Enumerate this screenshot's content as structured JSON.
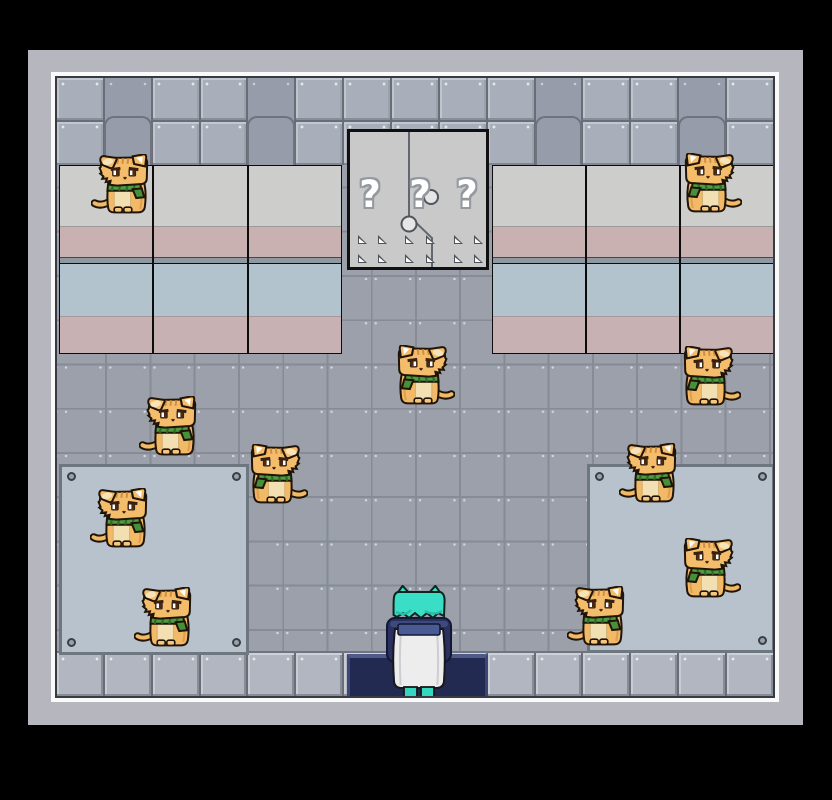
{
  "scene": {
    "type": "top-down pixel RPG room",
    "room": "metal-walled dormitory with tiled floor"
  },
  "door": {
    "question_marks": [
      "?",
      "?",
      "?"
    ]
  },
  "entities": {
    "player": {
      "x": 328,
      "y": 507,
      "facing": "up",
      "description": "teal-haired character with white robe standing on entrance mat"
    },
    "cats": [
      {
        "x": 34,
        "y": 76,
        "facing": "right"
      },
      {
        "x": 617,
        "y": 75,
        "facing": "left"
      },
      {
        "x": 330,
        "y": 267,
        "facing": "left"
      },
      {
        "x": 616,
        "y": 268,
        "facing": "left"
      },
      {
        "x": 82,
        "y": 318,
        "facing": "right"
      },
      {
        "x": 183,
        "y": 366,
        "facing": "left"
      },
      {
        "x": 33,
        "y": 410,
        "facing": "right"
      },
      {
        "x": 77,
        "y": 509,
        "facing": "right"
      },
      {
        "x": 562,
        "y": 365,
        "facing": "right"
      },
      {
        "x": 616,
        "y": 460,
        "facing": "left"
      },
      {
        "x": 510,
        "y": 508,
        "facing": "right"
      }
    ],
    "cat_count": 11
  },
  "colors": {
    "background": "#000000",
    "outer_wall": "#b6b6be",
    "inner_frame": "#fafafa",
    "floor": "#9ba0aa",
    "wall_panel": "#a9afba",
    "wall_panel_dark": "#969ca9",
    "machine_top": "#cdcdcc",
    "machine_pink": "#c9b1b1",
    "machine_blue": "#b3c3ce",
    "door_gray": "#c9c9c9",
    "mat_blue": "#b7c2cc",
    "entrance_navy": "#232a52",
    "cat_orange": "#f2ba66",
    "scarf_green": "#4f9b42",
    "player_teal": "#3adec6",
    "player_robe": "#ededee"
  }
}
